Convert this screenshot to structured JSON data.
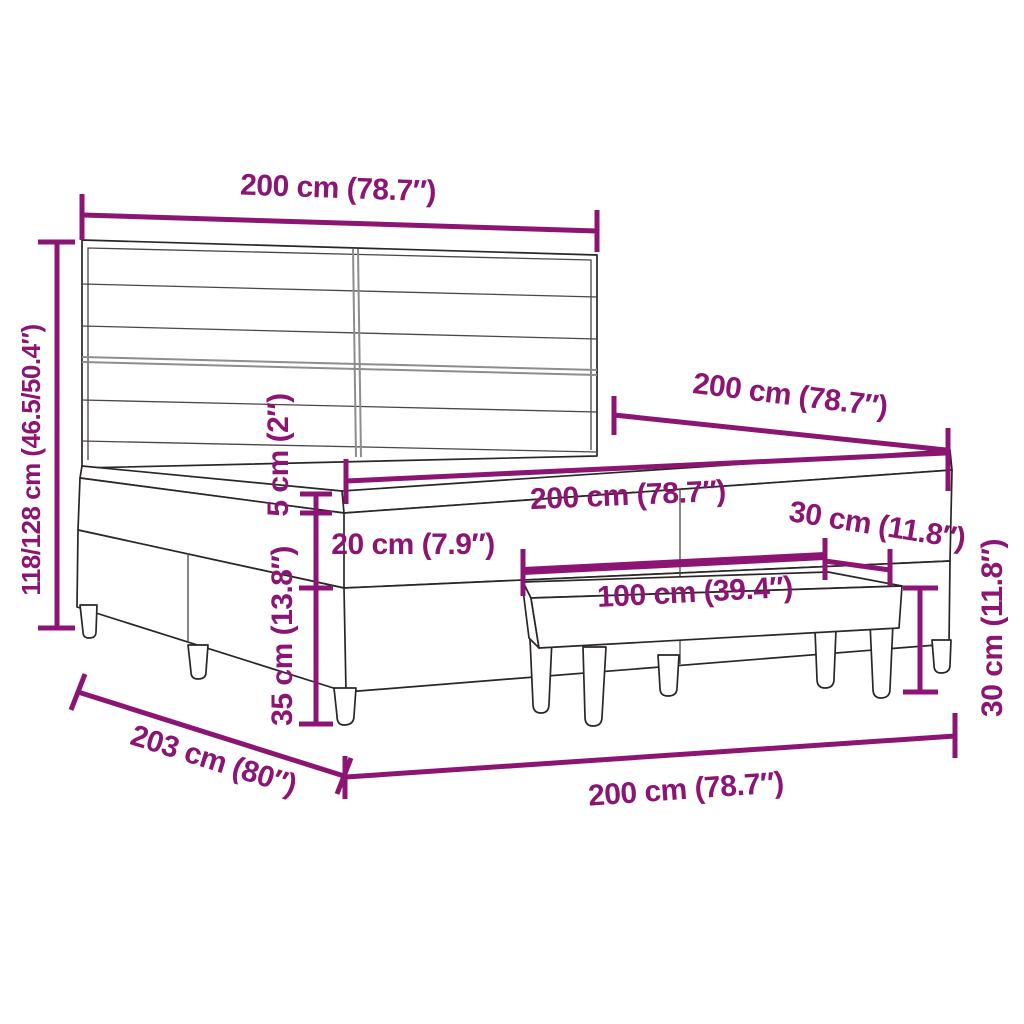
{
  "diagram": {
    "kind": "furniture-dimension-diagram",
    "subject": "box spring bed with striped headboard and bench",
    "colors": {
      "accent": "#8c1574",
      "ink": "#2a2527",
      "background": "#ffffff"
    },
    "labels": {
      "headboard_width": "200 cm (78.7″)",
      "total_height": "118/128 cm (46.5/50.4″)",
      "bed_length": "200 cm (78.7″)",
      "mattress_width": "200 cm (78.7″)",
      "topper_thickness": "5 cm (2″)",
      "box_height": "20 cm (7.9″)",
      "frame_height": "35 cm (13.8″)",
      "bench_length": "100 cm (39.4″)",
      "bench_depth": "30 cm (11.8″)",
      "bench_height": "30 cm (11.8″)",
      "floor_depth": "203 cm (80″)",
      "floor_width": "200 cm (78.7″)"
    }
  }
}
